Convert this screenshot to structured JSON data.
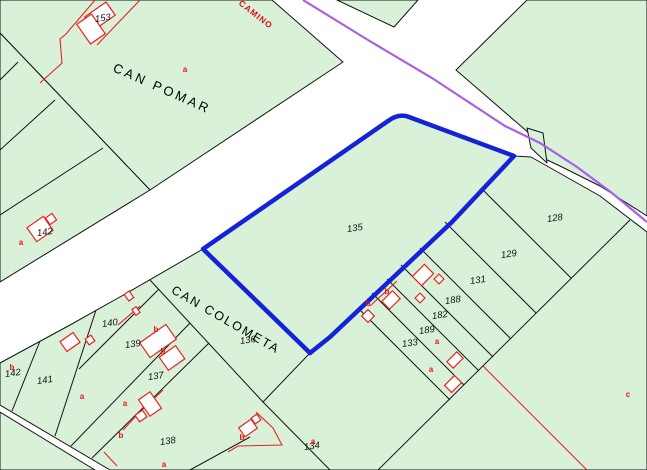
{
  "map": {
    "colors": {
      "background": "#ffffff",
      "parcel_fill": "#d9f0d9",
      "boundary": "#141414",
      "highlight": "#1523d6",
      "road_axis": "#a85fe6",
      "building": "#e8231e",
      "road_fill": "#ffffff"
    },
    "region_labels": [
      {
        "text": "CAN POMAR"
      },
      {
        "text": "CAN COLOMETA"
      }
    ],
    "road_label": {
      "text": "CAMINO"
    },
    "selected_parcel": {
      "number": "135"
    },
    "parcel_numbers": [
      {
        "text": "153"
      },
      {
        "text": "142"
      },
      {
        "text": "142"
      },
      {
        "text": "141"
      },
      {
        "text": "140"
      },
      {
        "text": "139"
      },
      {
        "text": "137"
      },
      {
        "text": "136"
      },
      {
        "text": "138"
      },
      {
        "text": "134"
      },
      {
        "text": "135"
      },
      {
        "text": "133"
      },
      {
        "text": "189"
      },
      {
        "text": "182"
      },
      {
        "text": "188"
      },
      {
        "text": "131"
      },
      {
        "text": "129"
      },
      {
        "text": "128"
      }
    ],
    "building_letters": [
      {
        "text": "a"
      },
      {
        "text": "a"
      },
      {
        "text": "b"
      },
      {
        "text": "a"
      },
      {
        "text": "a"
      },
      {
        "text": "b"
      },
      {
        "text": "a"
      },
      {
        "text": "b"
      },
      {
        "text": "a"
      },
      {
        "text": "b"
      },
      {
        "text": "b"
      },
      {
        "text": "b"
      },
      {
        "text": "b"
      },
      {
        "text": "a"
      },
      {
        "text": "a"
      },
      {
        "text": "c"
      }
    ]
  }
}
